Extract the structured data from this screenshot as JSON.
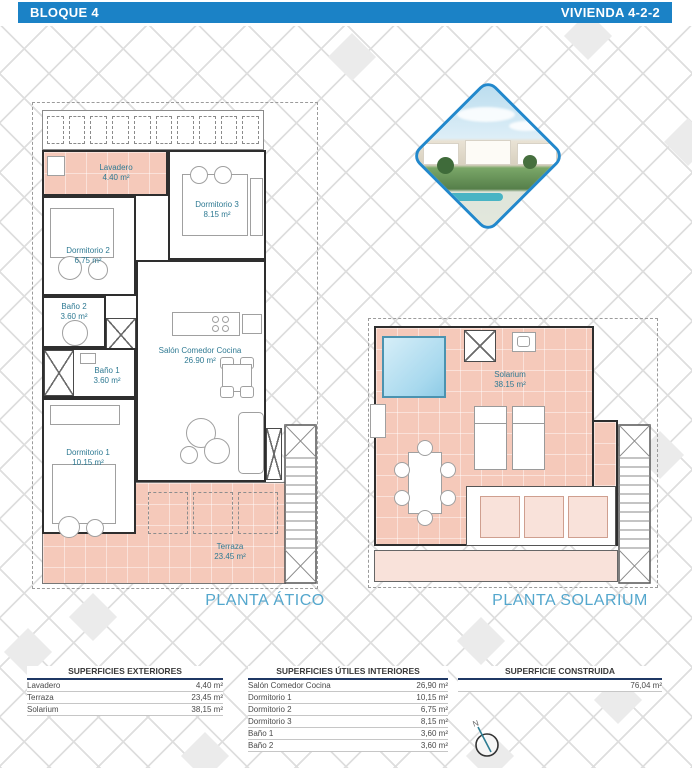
{
  "header": {
    "block": "BLOQUE 4",
    "unit": "VIVIENDA 4-2-2"
  },
  "plans": {
    "atico": {
      "title": "PLANTA ÁTICO",
      "rooms": {
        "lavadero": {
          "name": "Lavadero",
          "area": "4.40 m²"
        },
        "dormitorio3": {
          "name": "Dormitorio 3",
          "area": "8.15 m²"
        },
        "dormitorio2": {
          "name": "Dormitorio 2",
          "area": "6.75 m²"
        },
        "bano2": {
          "name": "Baño 2",
          "area": "3.60 m²"
        },
        "salon": {
          "name": "Salón Comedor Cocina",
          "area": "26.90 m²"
        },
        "bano1": {
          "name": "Baño 1",
          "area": "3.60 m²"
        },
        "dormitorio1": {
          "name": "Dormitorio 1",
          "area": "10.15 m²"
        },
        "terraza": {
          "name": "Terraza",
          "area": "23.45 m²"
        }
      }
    },
    "solarium": {
      "title": "PLANTA SOLARIUM",
      "rooms": {
        "solarium": {
          "name": "Solarium",
          "area": "38.15 m²"
        }
      }
    }
  },
  "tables": {
    "exteriores": {
      "title": "SUPERFICIES EXTERIORES",
      "rows": [
        {
          "label": "Lavadero",
          "value": "4,40 m²"
        },
        {
          "label": "Terraza",
          "value": "23,45 m²"
        },
        {
          "label": "Solarium",
          "value": "38,15 m²"
        }
      ]
    },
    "interiores": {
      "title": "SUPERFICIES ÚTILES INTERIORES",
      "rows": [
        {
          "label": "Salón Comedor Cocina",
          "value": "26,90 m²"
        },
        {
          "label": "Dormitorio 1",
          "value": "10,15 m²"
        },
        {
          "label": "Dormitorio 2",
          "value": "6,75 m²"
        },
        {
          "label": "Dormitorio 3",
          "value": "8,15 m²"
        },
        {
          "label": "Baño 1",
          "value": "3,60 m²"
        },
        {
          "label": "Baño 2",
          "value": "3,60 m²"
        }
      ]
    },
    "construida": {
      "title": "SUPERFICIE CONSTRUIDA",
      "value": "76,04 m²"
    }
  },
  "compass": {
    "label": "N"
  },
  "colors": {
    "header_bar": "#1b82c6",
    "plan_title": "#54a7cd",
    "room_label": "#2f7a93",
    "terrace_fill": "#f5c9ba",
    "terrace_light_fill": "#f9e2da",
    "pool_fill": "#a8d9ee",
    "table_rule": "#1f3864",
    "photo_border": "#2288cc"
  }
}
